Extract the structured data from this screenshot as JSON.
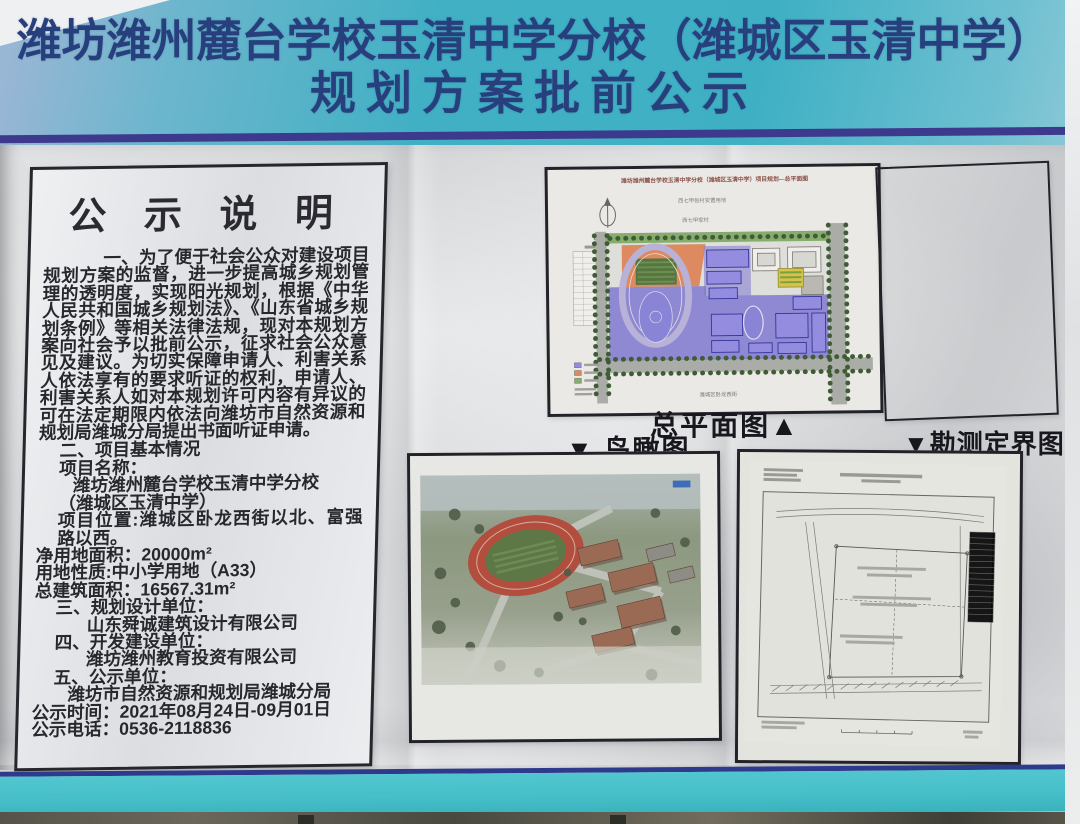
{
  "banner": {
    "line1": "潍坊潍州麓台学校玉清中学分校（潍城区玉清中学）",
    "line2": "规划方案批前公示"
  },
  "notice": {
    "title": "公 示 说 明",
    "lines": [
      {
        "text": "一、为了便于社会公众对建设项目规划方案的监督，进一步提高城乡规划管理的透明度，实现阳光规划，根据《中华人民共和国城乡规划法》、《山东省城乡规划条例》等相关法律法规，现对本规划方案向社会予以批前公示，征求社会公众意见及建议。为切实保障申请人、利害关系人依法享有的要求听证的权利，申请人、利害关系人如对本规划许可内容有异议的可在法定期限内依法向潍坊市自然资源和规划局潍城分局提出书面听证申请。",
        "cls": "para"
      },
      {
        "text": "二、项目基本情况",
        "cls": "ind1"
      },
      {
        "text": "项目名称：",
        "cls": "ind1"
      },
      {
        "text": "潍坊潍州麓台学校玉清中学分校",
        "cls": "ind2"
      },
      {
        "text": "（潍城区玉清中学）",
        "cls": "ind1"
      },
      {
        "text": "项目位置:潍城区卧龙西街以北、富强路以西。",
        "cls": "ind1"
      },
      {
        "text": "净用地面积：20000m²",
        "cls": "ind0"
      },
      {
        "text": "用地性质:中小学用地（A33）",
        "cls": "ind0"
      },
      {
        "text": "总建筑面积：16567.31m²",
        "cls": "ind0"
      },
      {
        "text": "三、规划设计单位：",
        "cls": "ind1"
      },
      {
        "text": "山东舜诚建筑设计有限公司",
        "cls": "ind3"
      },
      {
        "text": "四、开发建设单位：",
        "cls": "ind1"
      },
      {
        "text": "潍坊潍州教育投资有限公司",
        "cls": "ind3"
      },
      {
        "text": "五、公示单位：",
        "cls": "ind1"
      },
      {
        "text": "潍坊市自然资源和规划局潍城分局",
        "cls": "ind2"
      },
      {
        "text": "公示时间：2021年08月24日-09月01日",
        "cls": "ind0"
      },
      {
        "text": "公示电话：0536-2118836",
        "cls": "ind0"
      }
    ]
  },
  "plans": {
    "master": {
      "caption": "总平面图▲",
      "sheet_title": "潍坊潍州麓台学校玉清中学分校（潍城区玉清中学）项目规划—总平面图",
      "label_resettlement": "西七甲张村安置用地",
      "label_village": "西七甲家村",
      "label_road": "潍城区卧龙西街"
    },
    "aerial": {
      "caption": "▼ 鸟瞰图"
    },
    "survey": {
      "caption": "▼勘测定界图"
    }
  },
  "colors": {
    "banner_teal": "#3fb0c4",
    "stripe_navy": "#3d3a8e",
    "board_gray": "#d2d4d6",
    "text_dark": "#27282d",
    "plan_purple": "#7d76d0",
    "plan_orange": "#dd8a60",
    "plan_green": "#55763f",
    "track_red": "#b34e3e",
    "bottom_teal": "#46bfc9"
  }
}
